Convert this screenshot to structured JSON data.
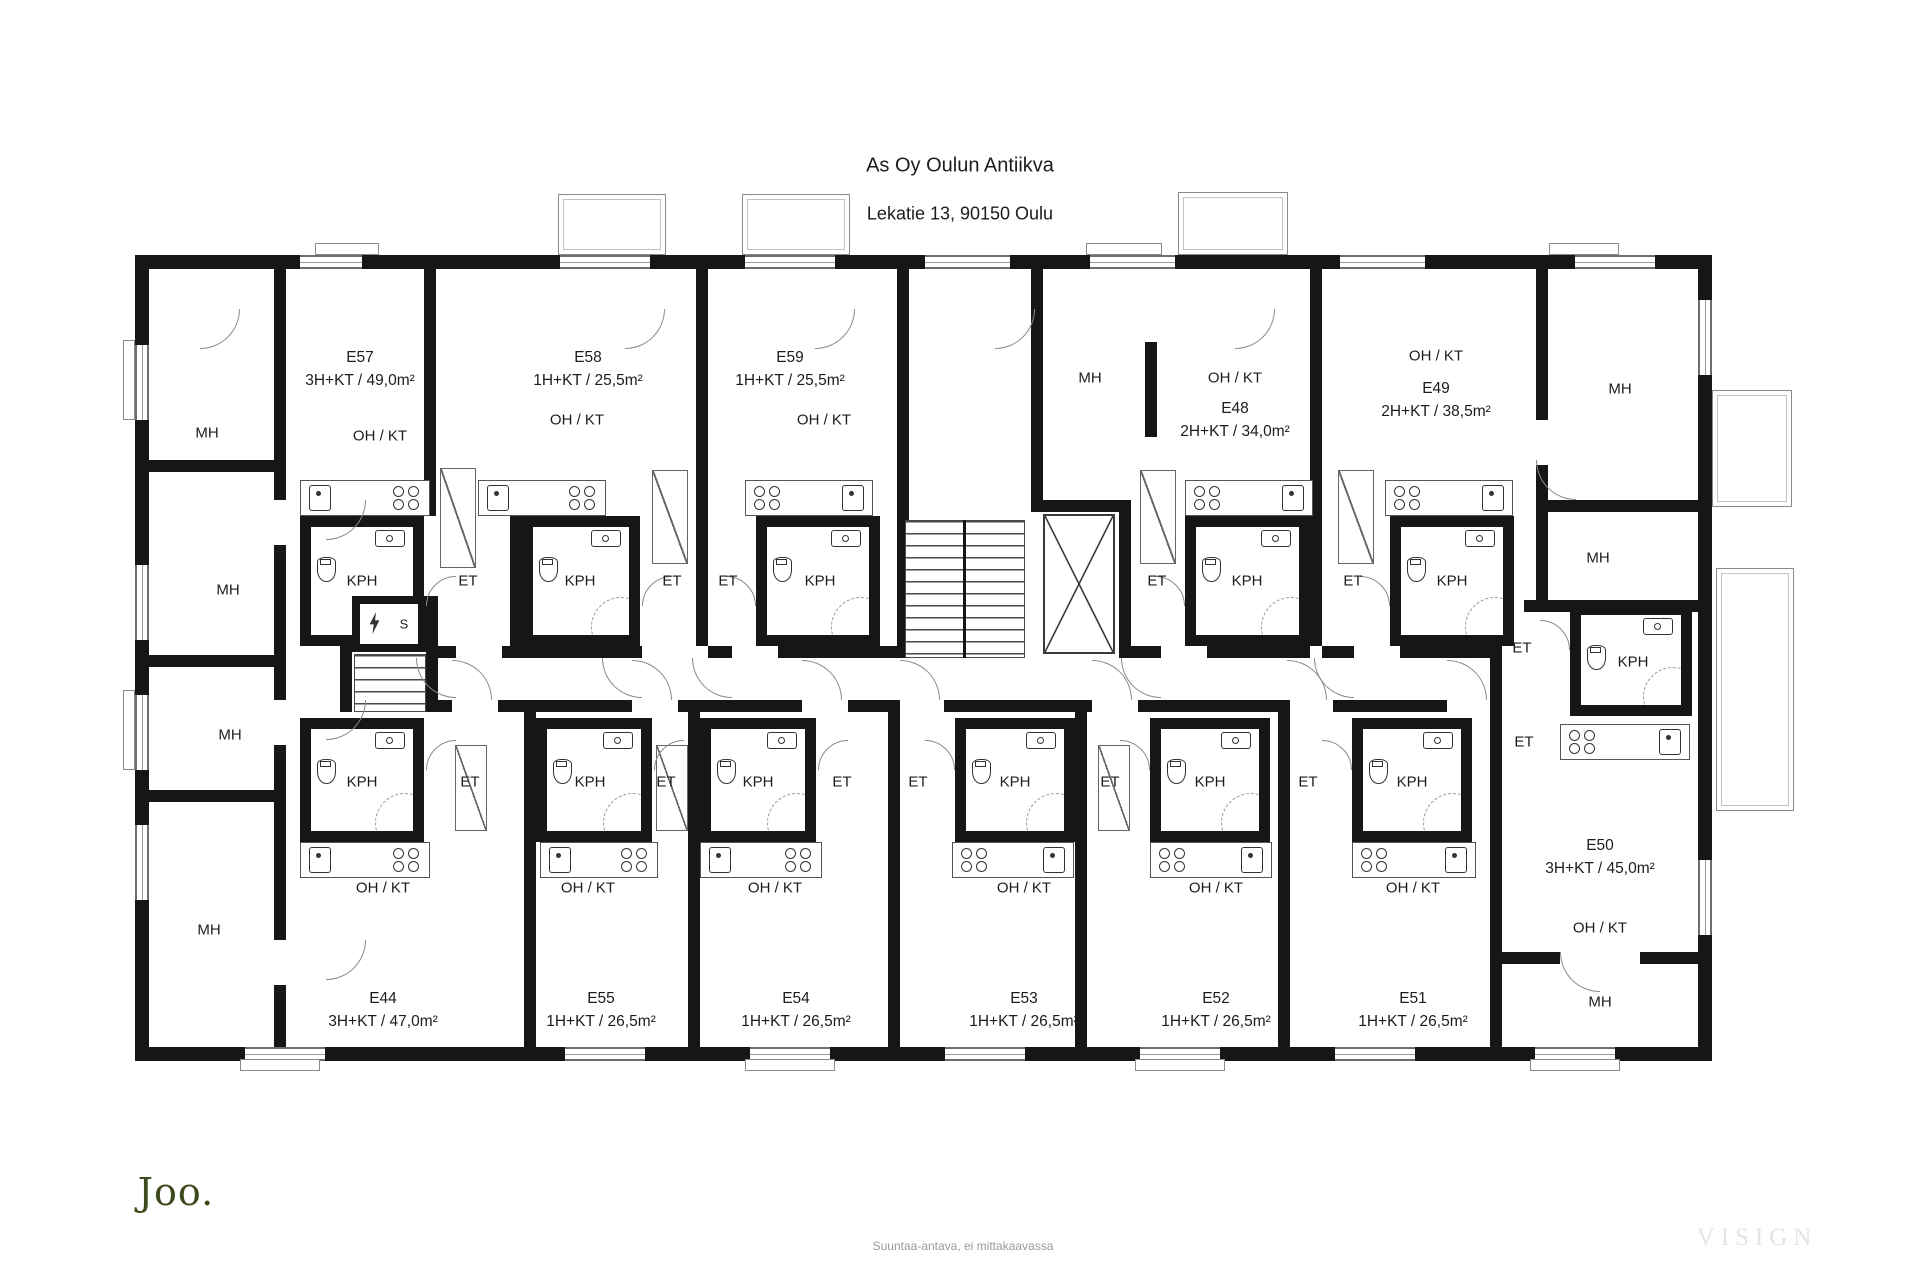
{
  "header": {
    "title": "As Oy Oulun Antiikva",
    "subtitle": "Lekatie 13, 90150 Oulu"
  },
  "apartments": [
    {
      "id": "E57",
      "spec": "3H+KT / 49,0m²"
    },
    {
      "id": "E58",
      "spec": "1H+KT / 25,5m²"
    },
    {
      "id": "E59",
      "spec": "1H+KT / 25,5m²"
    },
    {
      "id": "E48",
      "spec": "2H+KT / 34,0m²"
    },
    {
      "id": "E49",
      "spec": "2H+KT / 38,5m²"
    },
    {
      "id": "E50",
      "spec": "3H+KT / 45,0m²"
    },
    {
      "id": "E44",
      "spec": "3H+KT / 47,0m²"
    },
    {
      "id": "E55",
      "spec": "1H+KT / 26,5m²"
    },
    {
      "id": "E54",
      "spec": "1H+KT / 26,5m²"
    },
    {
      "id": "E53",
      "spec": "1H+KT / 26,5m²"
    },
    {
      "id": "E52",
      "spec": "1H+KT / 26,5m²"
    },
    {
      "id": "E51",
      "spec": "1H+KT / 26,5m²"
    }
  ],
  "room_labels": {
    "living_kitchen": "OH / KT",
    "bedroom": "MH",
    "bathroom": "KPH",
    "entry": "ET",
    "electrical_room": "S"
  },
  "footer": {
    "logo": "Joo.",
    "note": "Suuntaa-antava, ei mittakaavassa",
    "watermark": "VISIGN"
  },
  "colors": {
    "wall": "#161616",
    "thin_line": "#6e6e6e",
    "logo_green": "#3c4a1c",
    "note_gray": "#9a9a9a",
    "watermark_gray": "#e4e4e0"
  }
}
